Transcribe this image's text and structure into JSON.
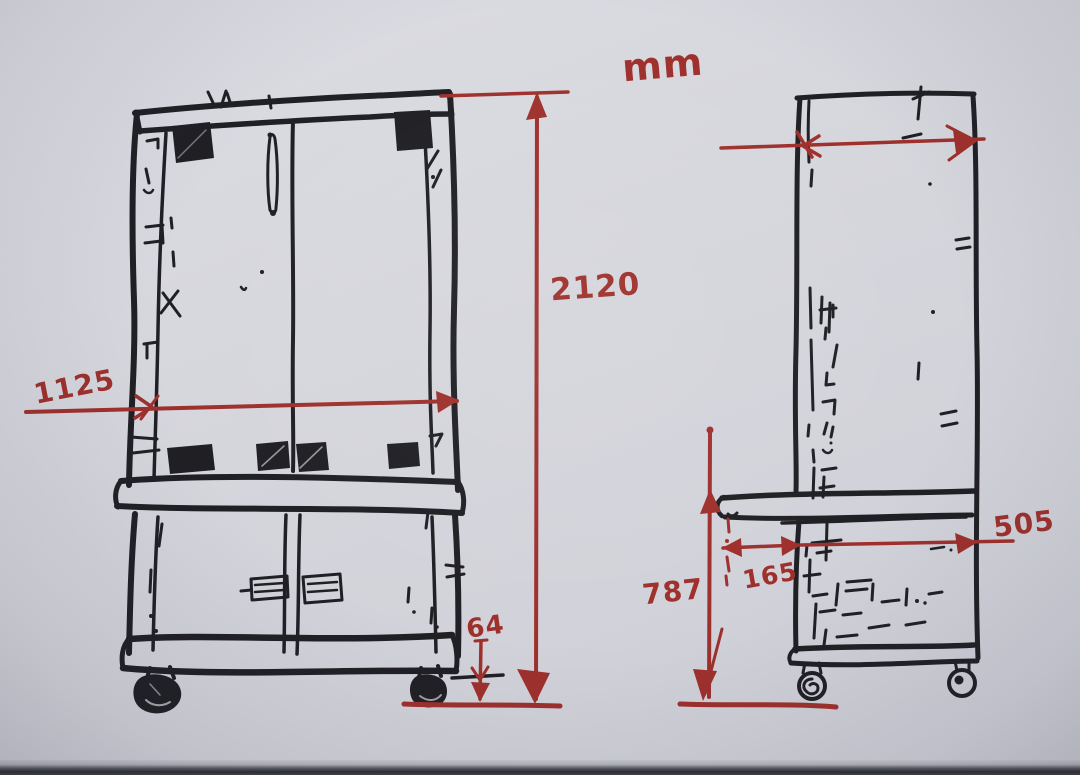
{
  "photo": {
    "kind": "hand-drawn dimension sketch",
    "unit_label": "mm"
  },
  "colors": {
    "paper": "#d5d6dc",
    "ink": "#1f1f24",
    "marker": "#9e302c"
  },
  "labels": {
    "unit": "mm",
    "overall_height": "2120",
    "overall_width": "1125",
    "caster_height": "64",
    "bench_height": "787",
    "overhang_depth": "165",
    "body_depth": "505"
  },
  "views": {
    "front": {
      "dimension_values": [
        "2120",
        "1125",
        "64"
      ]
    },
    "side": {
      "dimension_values": [
        "787",
        "165",
        "505"
      ]
    }
  }
}
